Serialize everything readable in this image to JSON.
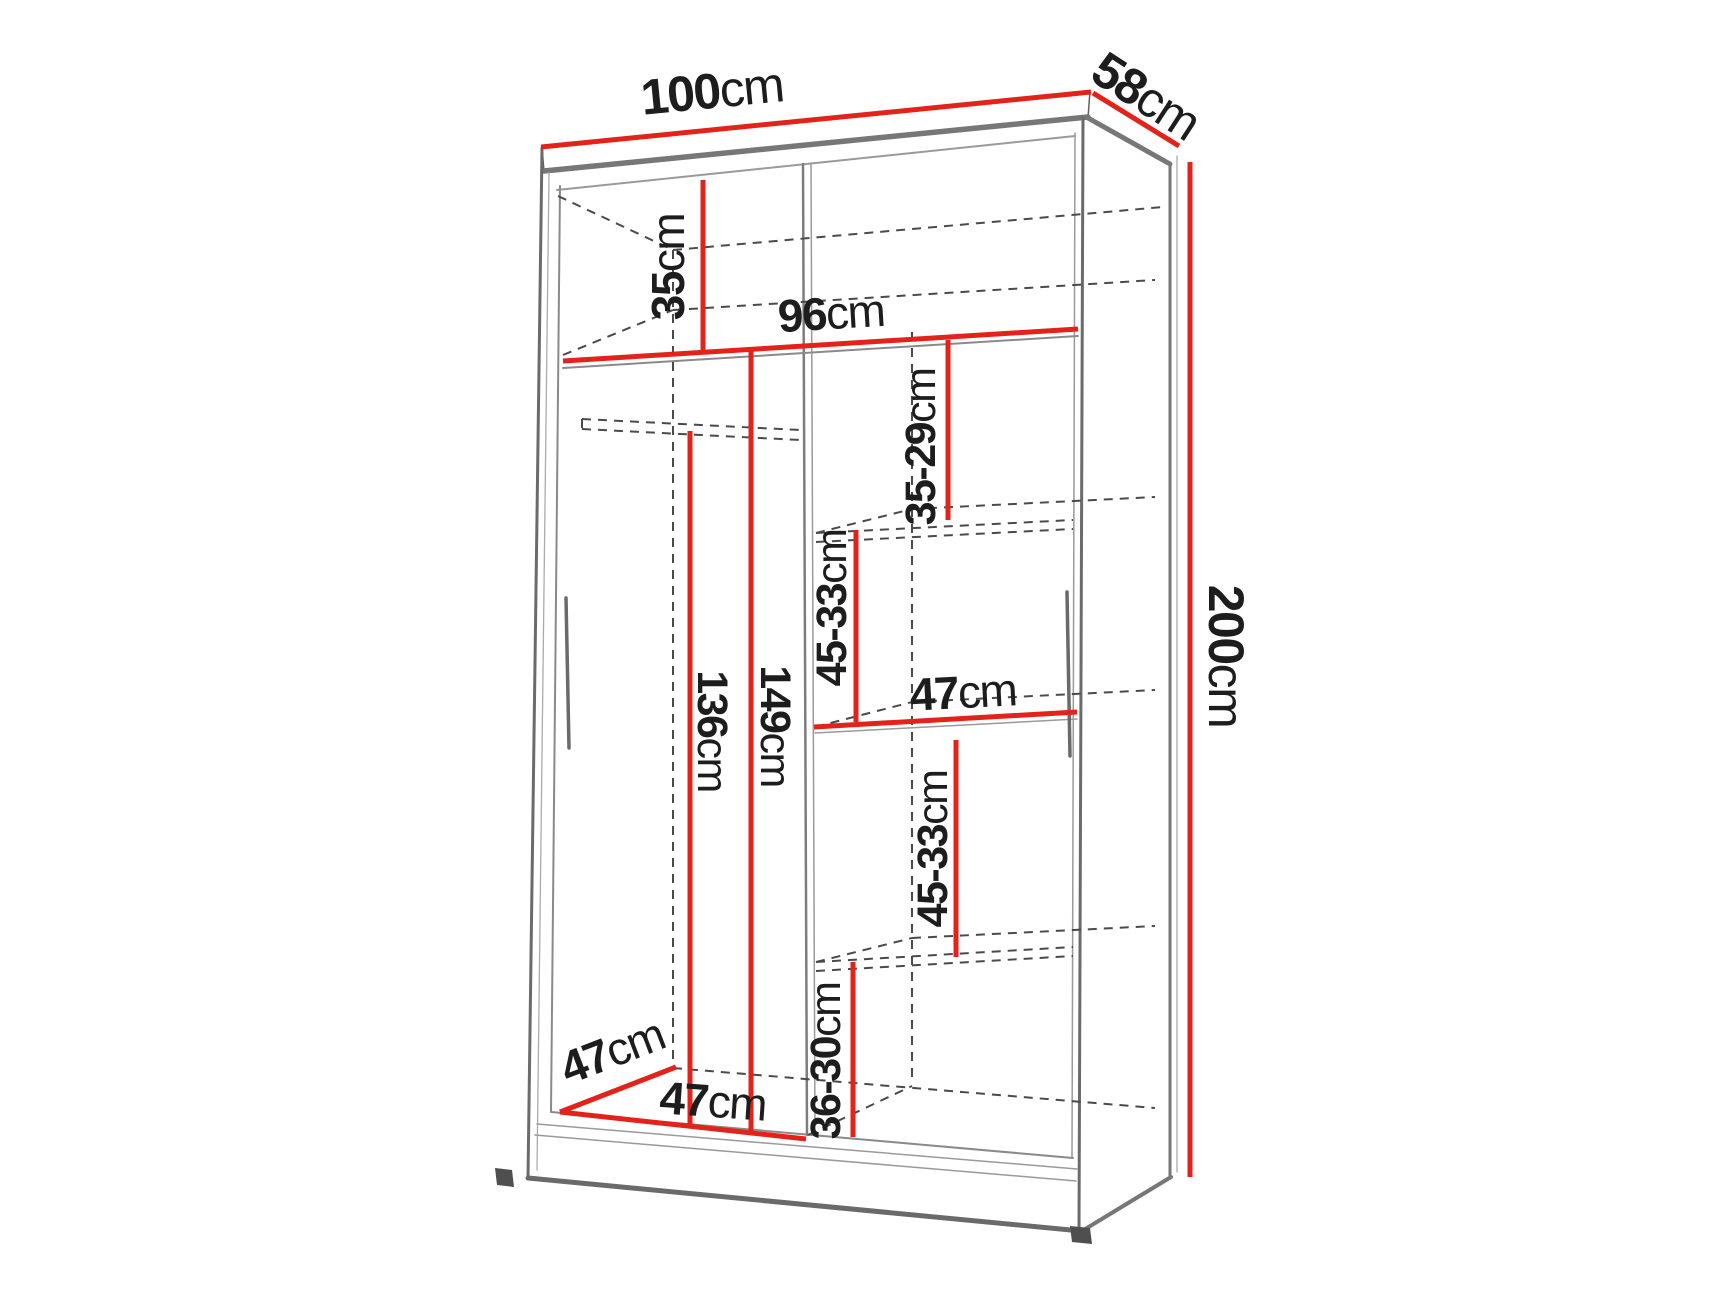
{
  "diagram": {
    "type": "furniture-dimension-diagram",
    "subject": "wardrobe interior dimensions",
    "unit": "cm",
    "colors": {
      "dimension_line": "#e32219",
      "structure_line": "#7d7d7d",
      "hidden_line": "#4a4a4a",
      "label_text": "#1d1d1d",
      "background": "#ffffff"
    },
    "overall": {
      "width_label": {
        "value": "100",
        "unit": "cm"
      },
      "depth_label": {
        "value": "58",
        "unit": "cm"
      },
      "height_label": {
        "value": "200",
        "unit": "cm"
      }
    },
    "interior": {
      "top_shelf_height": {
        "value": "35",
        "unit": "cm"
      },
      "interior_width": {
        "value": "96",
        "unit": "cm"
      },
      "upper_gap": {
        "value": "35-29",
        "unit": "cm"
      },
      "gap_above_mid_shelf": {
        "value": "45-33",
        "unit": "cm"
      },
      "right_shelf_width": {
        "value": "47",
        "unit": "cm"
      },
      "gap_below_mid_shelf": {
        "value": "45-33",
        "unit": "cm"
      },
      "bottom_gap": {
        "value": "36-30",
        "unit": "cm"
      },
      "hanging_space_height": {
        "value": "136",
        "unit": "cm"
      },
      "left_section_height": {
        "value": "149",
        "unit": "cm"
      },
      "interior_depth": {
        "value": "47",
        "unit": "cm"
      },
      "left_section_width": {
        "value": "47",
        "unit": "cm"
      }
    }
  }
}
